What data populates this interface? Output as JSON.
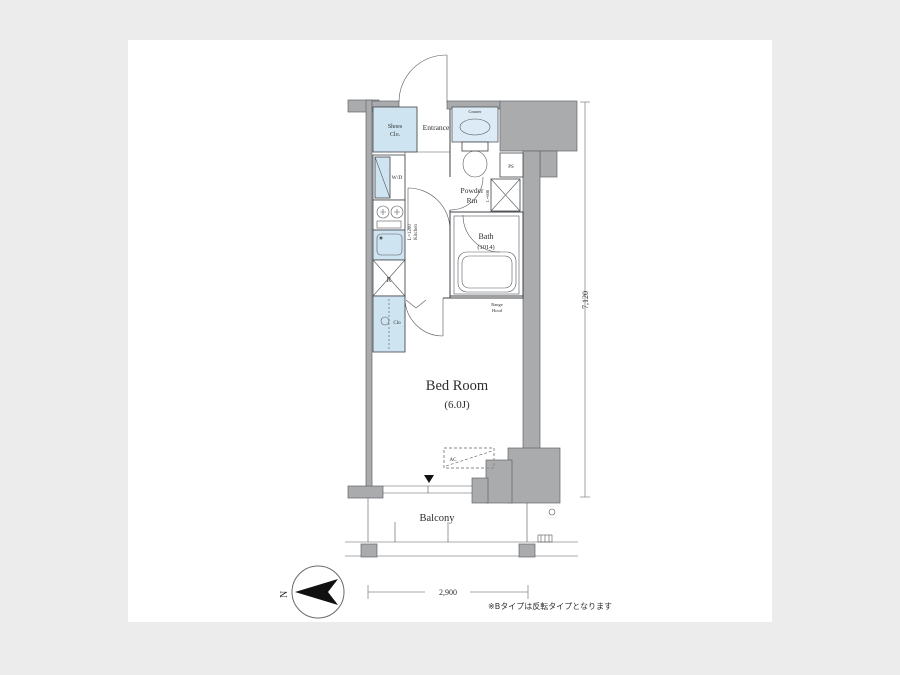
{
  "labels": {
    "shoes_clo_1": "Shoes",
    "shoes_clo_2": "Clo.",
    "entrance": "Entrance",
    "counter": "Counter",
    "powder_1": "Powder",
    "powder_2": "Rm",
    "ps": "PS",
    "washer_note": "L=608",
    "wd": "W/D",
    "kitchen_len": "L=1200",
    "kitchen": "Kitchen",
    "fridge": "R",
    "closet": "Clo",
    "bath_1": "Bath",
    "bath_2": "(1014)",
    "range_hood_1": "Range",
    "range_hood_2": "Hood",
    "bedroom_1": "Bed Room",
    "bedroom_2": "(6.0J)",
    "ac": "AC",
    "balcony": "Balcony"
  },
  "dimensions": {
    "height": "7,120",
    "width": "2,900"
  },
  "compass": {
    "north": "N"
  },
  "footnote": "※Bタイプは反転タイプとなります",
  "colors": {
    "wall_gray": "#a9abad",
    "fixture_blue": "#cfe4f1",
    "line": "#3f4245",
    "canvas": "#ffffff",
    "page_background": "#ececec"
  }
}
